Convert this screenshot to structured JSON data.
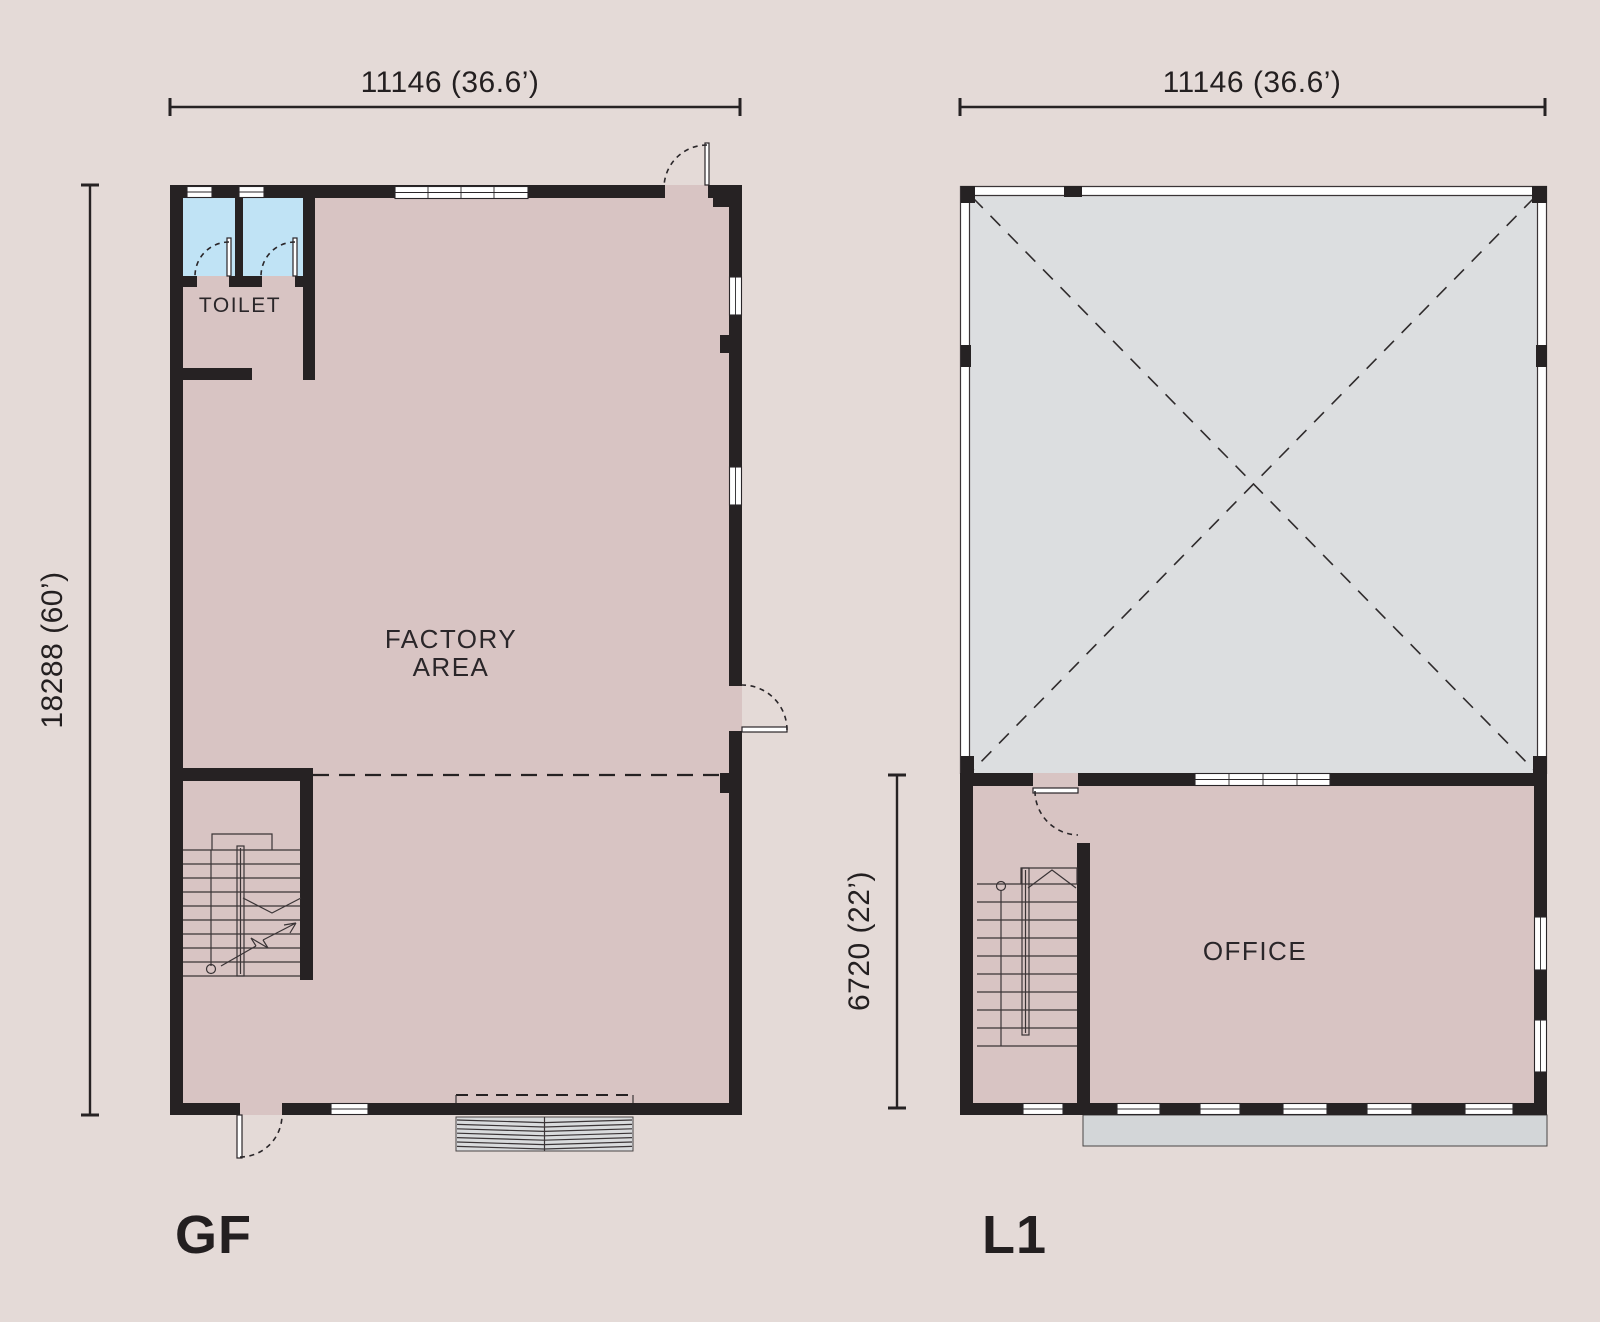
{
  "colors": {
    "background": "#e4dad7",
    "floor_pink": "#d8c4c3",
    "toilet_blue": "#c0e3f5",
    "void_gray": "#dcdee0",
    "canopy_gray": "#d3d6d8",
    "wall_black": "#262223",
    "text": "#231f20"
  },
  "plans": {
    "gf": {
      "name_label": "GF",
      "dim_width": "11146 (36.6’)",
      "dim_height": "18288 (60’)",
      "toilet_label": "TOILET",
      "factory_line1": "FACTORY",
      "factory_line2": "AREA"
    },
    "l1": {
      "name_label": "L1",
      "dim_width": "11146 (36.6’)",
      "dim_height": "6720 (22’)",
      "office_label": "OFFICE"
    }
  }
}
